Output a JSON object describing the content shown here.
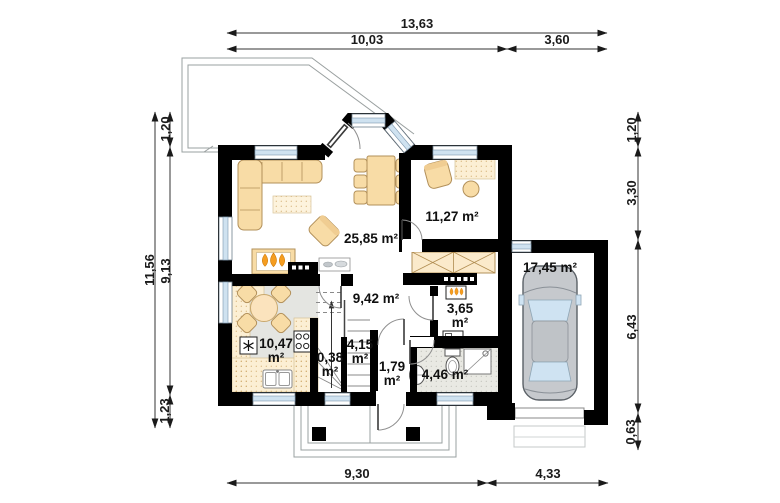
{
  "colors": {
    "wall": "#000000",
    "glass": "#cfe2f0",
    "glassframe": "#7d97ad",
    "furniture": "#f8dca6",
    "furniture_stroke": "#b2905a",
    "floor_gray": "#e4e5e1",
    "counter": "#fcefd4",
    "flame": "#f59d20",
    "car_body": "#c6c9cd",
    "car_glass": "#cfe3f2",
    "outline_gray": "#9aa0a0",
    "dim": "#1a1a1a"
  },
  "dimensions": {
    "top_total": "13,63",
    "top_main": "10,03",
    "top_garage": "3,60",
    "bottom_main": "9,30",
    "bottom_garage": "4,33",
    "left_total": "11,56",
    "left_bay": "1,20",
    "left_house": "9,13",
    "left_porch": "1,23",
    "right_bay": "1,20",
    "right_office": "3,30",
    "right_garage": "6,43",
    "right_apron": "0,63"
  },
  "rooms": {
    "living": {
      "label": "25,85 m²"
    },
    "office": {
      "label": "11,27 m²"
    },
    "garage": {
      "label": "17,45 m²"
    },
    "hall": {
      "label": "9,42 m²"
    },
    "bath": {
      "label": "4,46 m²"
    },
    "kitchen": {
      "value": "10,47",
      "unit": "m²"
    },
    "closet": {
      "value": "0,38",
      "unit": "m²"
    },
    "stairs": {
      "value": "4,15",
      "unit": "m²"
    },
    "vestibule": {
      "value": "1,79",
      "unit": "m²"
    },
    "boiler": {
      "value": "3,65",
      "unit": "m²"
    }
  }
}
